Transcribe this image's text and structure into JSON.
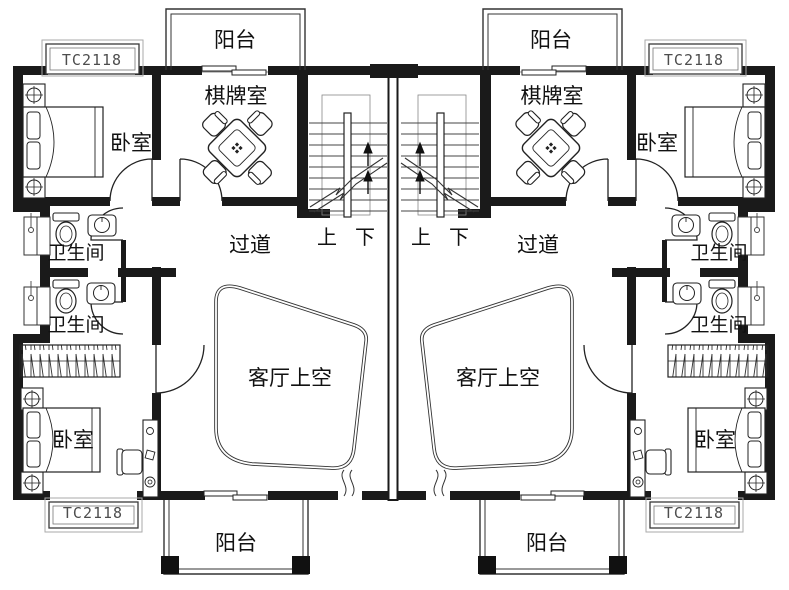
{
  "plan": {
    "type": "residential-duplex-floor-plan",
    "labels": {
      "balcony": "阳台",
      "bedroom": "卧室",
      "chess_room": "棋牌室",
      "bathroom": "卫生间",
      "corridor": "过道",
      "living_room_void": "客厅上空",
      "stairs_up": "上",
      "stairs_down": "下",
      "window_code": "TC2118"
    },
    "label_counts": {
      "balcony": 4,
      "bedroom": 4,
      "chess_room": 2,
      "bathroom": 4,
      "corridor": 2,
      "living_room_void": 2,
      "stairs_up": 2,
      "stairs_down": 2,
      "window_code": 4
    },
    "colors": {
      "wall_line": "#1a1a1a",
      "thin_line": "#555555",
      "background": "#ffffff",
      "label_text": "#111111",
      "window_code_text": "#4d4d4d"
    }
  }
}
